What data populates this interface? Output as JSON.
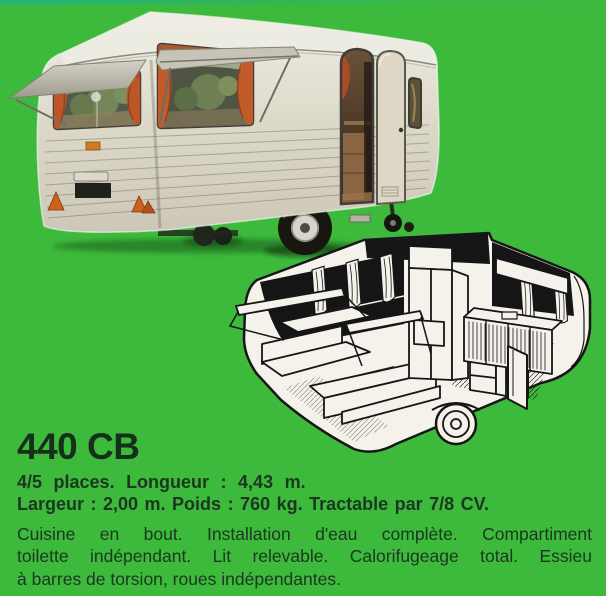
{
  "colors": {
    "background": "#3db93c",
    "title_ink": "#152f1a",
    "ink": "#1b3721",
    "curtain_orange": "#bd5527",
    "body_cream": "#ddd9ca",
    "line_art_ink": "#161616"
  },
  "model": {
    "name": "440 CB"
  },
  "specs": {
    "line1": "4/5 places. Longueur : 4,43 m.",
    "line2": "Largeur : 2,00 m. Poids : 760 kg. Tractable par 7/8 CV."
  },
  "description": {
    "lines": [
      "Cuisine en bout. Installation d'eau complète. Compartiment",
      "toilette indépendant. Lit relevable. Calorifugeage total. Essieu",
      "à barres de torsion, roues indépendantes."
    ]
  }
}
